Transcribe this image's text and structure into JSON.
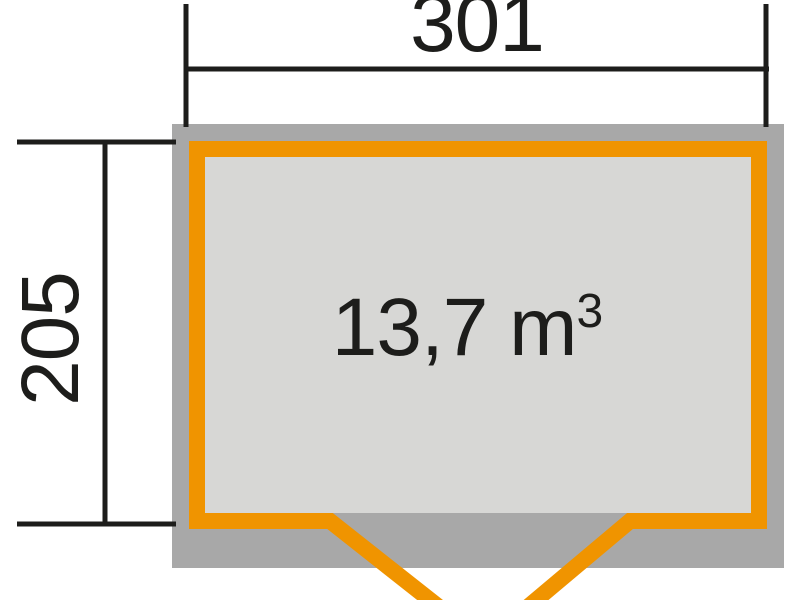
{
  "plan": {
    "title": "shed-floor-plan",
    "width_dimension": "301",
    "depth_dimension": "205",
    "volume_value": "13,7 m",
    "volume_exponent": "3"
  },
  "colors": {
    "orange": "#f09400",
    "wall_gray": "#a8a8a8",
    "floor_gray": "#d7d7d5",
    "line_black": "#1d1d1b",
    "background": "#ffffff"
  }
}
